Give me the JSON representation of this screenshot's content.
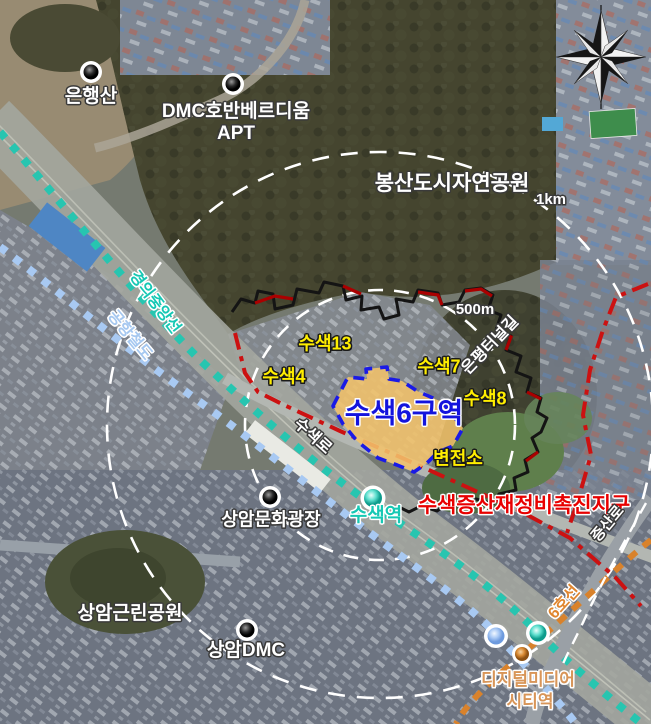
{
  "map": {
    "places": {
      "eunhaengsan": "은행산",
      "dmc_apt_line1": "DMC호반베르디움",
      "dmc_apt_line2": "APT",
      "bongsan_park": "봉산도시자연공원",
      "sangam_plaza": "상암문화광장",
      "sangam_park": "상암근린공원",
      "sangam_dmc": "상암DMC",
      "substation": "변전소"
    },
    "zones": {
      "zone6": "수색6구역",
      "zone4": "수색4",
      "zone7": "수색7",
      "zone8": "수색8",
      "zone13": "수색13",
      "district": "수색증산재정비촉진지구"
    },
    "stations": {
      "susaek": "수색역",
      "dmc_line1": "디지털미디어",
      "dmc_line2": "시티역"
    },
    "roads": {
      "susaek_ro": "수색로",
      "jeungsan_ro": "증산로",
      "eunpyeong_tunnel": "은평터널길"
    },
    "rail_lines": {
      "gyeongui": "경의중앙선",
      "airport": "공항철도",
      "line6": "6호선"
    },
    "radii": {
      "r500": "500m",
      "r1000": "1km"
    },
    "icons": {
      "compass": "compass-rose",
      "poi": "poi-marker",
      "station": "station-marker"
    },
    "colors": {
      "zone6_fill": "#f2c36b",
      "zone6_border": "#1a1ae6",
      "district_line": "#cc1111",
      "district_label": "#e80000",
      "zone_label": "#ffee00",
      "gyeongui_line": "#27c5b0",
      "airport_line": "#a8c9f2",
      "line6": "#e0862f",
      "station_susaek": "#17c8b4",
      "dmc_station_label": "#d89558",
      "radius_circles": "#ffffff"
    }
  }
}
